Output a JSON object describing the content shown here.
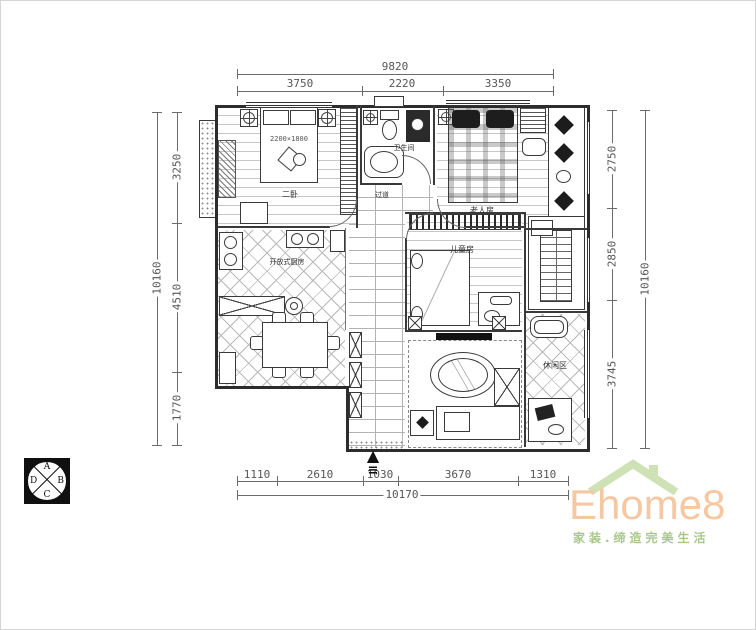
{
  "dimensions": {
    "top": {
      "total": "9820",
      "segments": [
        "3750",
        "2220",
        "3350"
      ]
    },
    "bottom": {
      "total": "10170",
      "segments": [
        "1110",
        "2610",
        "1030",
        "3670",
        "1310"
      ]
    },
    "left": {
      "total": "10160",
      "segments": [
        "3250",
        "4510",
        "1770"
      ]
    },
    "right": {
      "total": "10160",
      "segments": [
        "2750",
        "2850",
        "3745"
      ]
    }
  },
  "rooms": {
    "bedroom2": "二卧",
    "bathroom": "卫生间",
    "elder": "老人房",
    "kitchen": "开放式厨房",
    "kids": "儿童房",
    "leisure": "休闲区",
    "hallway": "过道",
    "bed_size": "2200×1800"
  },
  "compass": {
    "top": "A",
    "right": "B",
    "bottom": "C",
    "left": "D"
  },
  "entrance": {
    "arrow": "▲",
    "threshold": "≡"
  },
  "logo": {
    "brand": "Ehome8",
    "tagline": "家装.缔造完美生活",
    "brand_color": "#f5c8a1",
    "roof_color": "#cfe2b6",
    "tagline_color": "#a9c78d"
  },
  "drawing": {
    "line_color": "#3a3a3a",
    "dim_color": "#5a5a5a"
  }
}
